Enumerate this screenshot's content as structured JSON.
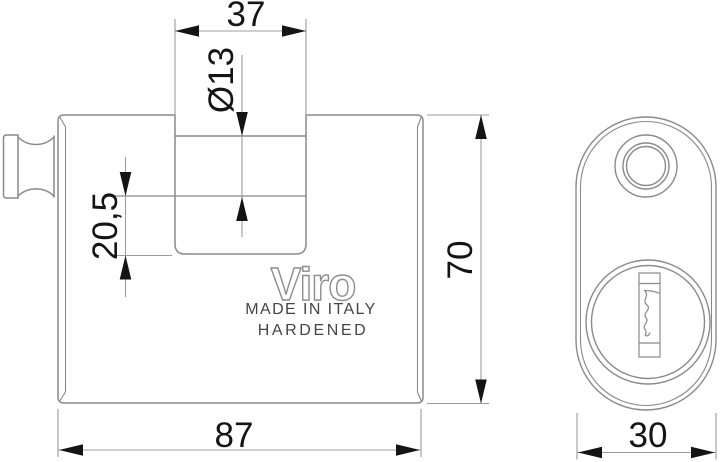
{
  "front_view": {
    "logo": "Viro",
    "made_in_italy": "MADE IN ITALY",
    "hardened": "HARDENED",
    "dimensions": {
      "slot_width": "37",
      "shackle_diameter": "Ø13",
      "shackle_offset": "20,5",
      "height": "70",
      "width": "87"
    }
  },
  "side_view": {
    "dimensions": {
      "depth": "30"
    }
  },
  "style": {
    "background": "#ffffff",
    "object_line_color": "#8a8a8a",
    "dimension_line_color": "#9c9c9c",
    "dimension_text_color": "#141414",
    "logo_outline_color": "#8d8d8d",
    "label_text_color": "#454545"
  }
}
